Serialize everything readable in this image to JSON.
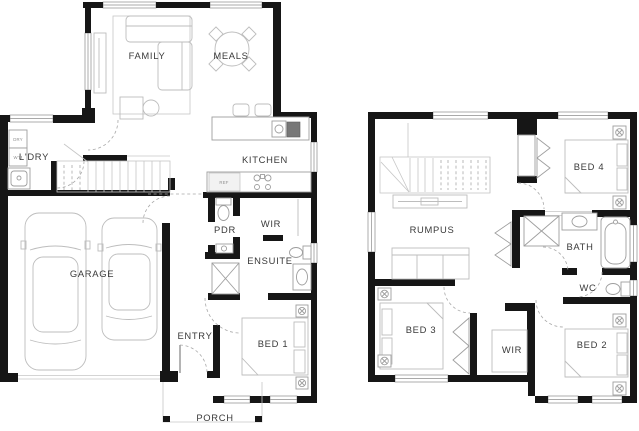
{
  "document": {
    "type": "floor-plan",
    "background": "#ffffff"
  },
  "colors": {
    "wall": "#161616",
    "furniture_line": "#bdbdbd",
    "fixture_line": "#9e9e9e",
    "label_text": "#3a3a3a",
    "tiny_label_text": "#8f8f8f",
    "appliance_dark": "#787878"
  },
  "ground_floor": {
    "family": "FAMILY",
    "meals": "MEALS",
    "kitchen": "KITCHEN",
    "laundry": "L'DRY",
    "dryer": "DRY",
    "washer": "W'M",
    "fridge": "REF",
    "powder": "PDR",
    "wir": "WIR",
    "ensuite": "ENSUITE",
    "garage": "GARAGE",
    "entry": "ENTRY",
    "bed1": "BED 1",
    "porch": "PORCH"
  },
  "first_floor": {
    "rumpus": "RUMPUS",
    "bed4": "BED 4",
    "bath": "BATH",
    "wc": "WC",
    "bed3": "BED 3",
    "wir": "WIR",
    "bed2": "BED 2"
  }
}
